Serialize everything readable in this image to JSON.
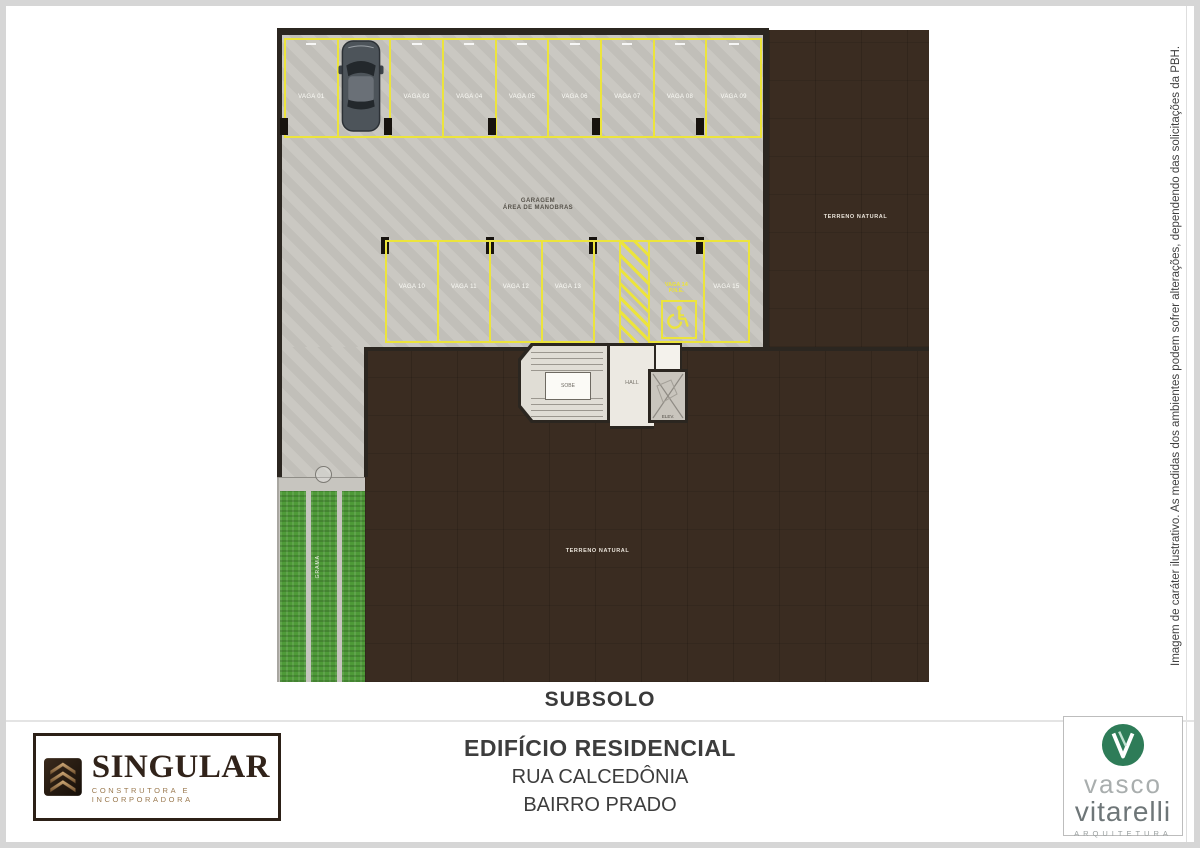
{
  "plan": {
    "title": "SUBSOLO",
    "labels": {
      "garage_line1": "GARAGEM",
      "garage_line2": "ÁREA DE MANOBRAS",
      "terrain_right": "TERRENO NATURAL",
      "terrain_bottom": "TERRENO NATURAL",
      "hall": "HALL",
      "stairs": "SOBE",
      "elevator": "ELEV.",
      "garden": "GRAMA"
    },
    "row1_spaces": [
      "VAGA 01",
      "VAGA 02",
      "VAGA 03",
      "VAGA 04",
      "VAGA 05",
      "VAGA 06",
      "VAGA 07",
      "VAGA 08",
      "VAGA 09"
    ],
    "row2_spaces": [
      "VAGA 10",
      "VAGA 11",
      "VAGA 12",
      "VAGA 13"
    ],
    "accessible_space": {
      "line1": "VAGA 14",
      "line2": "P.N.E."
    },
    "row2_last_space": "VAGA 15"
  },
  "disclaimer": "Imagem de caráter ilustrativo. As medidas dos ambientes podem sofrer alterações, dependendo das solicitações da PBH.",
  "footer": {
    "project_title": "EDIFÍCIO RESIDENCIAL",
    "street": "RUA CALCEDÔNIA",
    "district": "BAIRRO PRADO",
    "developer_logo": {
      "name": "SINGULAR",
      "tagline": "CONSTRUTORA E INCORPORADORA"
    },
    "architect_logo": {
      "first_name": "vasco",
      "last_name": "vitarelli",
      "tagline": "ARQUITETURA"
    }
  },
  "colors": {
    "terrain": "#3a2c21",
    "concrete": "#c7c5bf",
    "line": "#ece43c",
    "grass": "#4e9a38",
    "wall": "#2b2620"
  }
}
